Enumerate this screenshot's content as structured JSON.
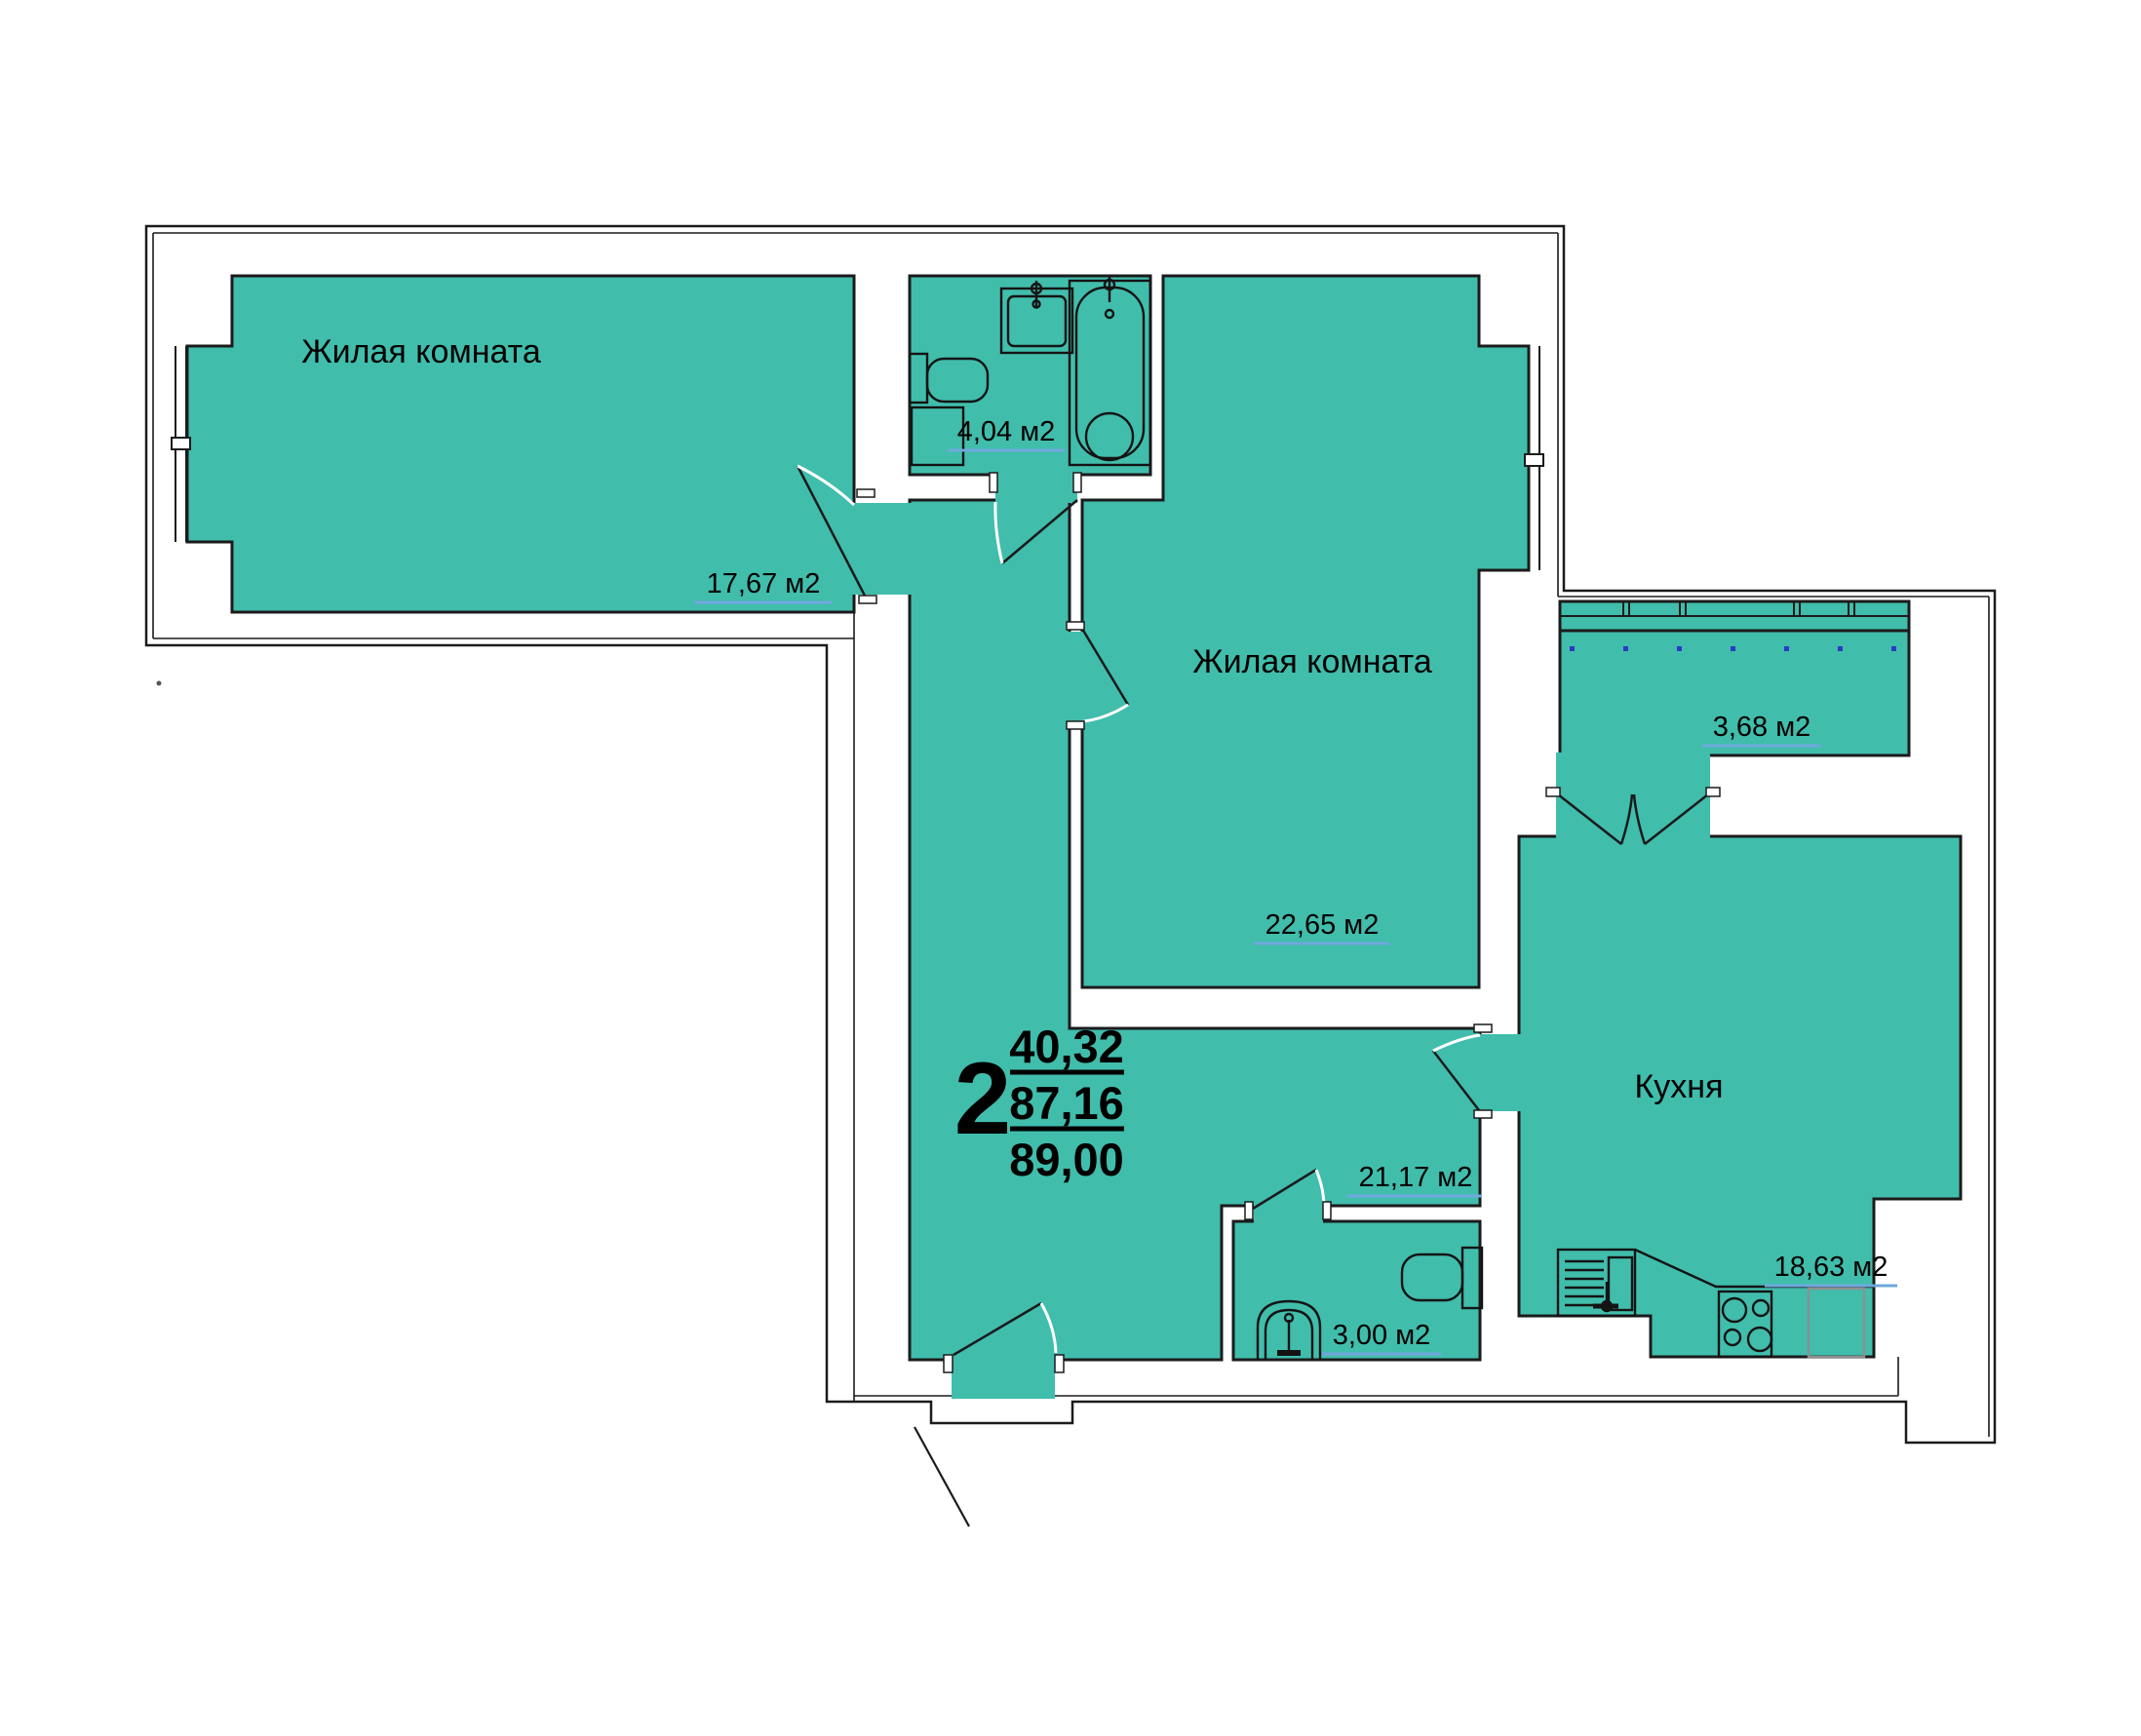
{
  "plan": {
    "colors": {
      "room_fill": "#41BDAC",
      "wall_line": "#1b1b1b",
      "area_underline": "#6FA8DC",
      "window_dot": "#2b3bc0"
    },
    "rooms": [
      {
        "id": "living-room-1",
        "name": "Жилая комната",
        "area": "17,67 м2"
      },
      {
        "id": "living-room-2",
        "name": "Жилая комната",
        "area": "22,65 м2"
      },
      {
        "id": "kitchen",
        "name": "Кухня",
        "area": "18,63 м2"
      },
      {
        "id": "bathroom",
        "name": "",
        "area": "4,04 м2"
      },
      {
        "id": "wc",
        "name": "",
        "area": "3,00 м2"
      },
      {
        "id": "hallway",
        "name": "",
        "area": "21,17 м2"
      },
      {
        "id": "loggia",
        "name": "",
        "area": "3,68 м2"
      }
    ],
    "summary": {
      "rooms_count": "2",
      "living_area": "40,32",
      "apartment_area": "87,16",
      "total_area": "89,00"
    }
  }
}
